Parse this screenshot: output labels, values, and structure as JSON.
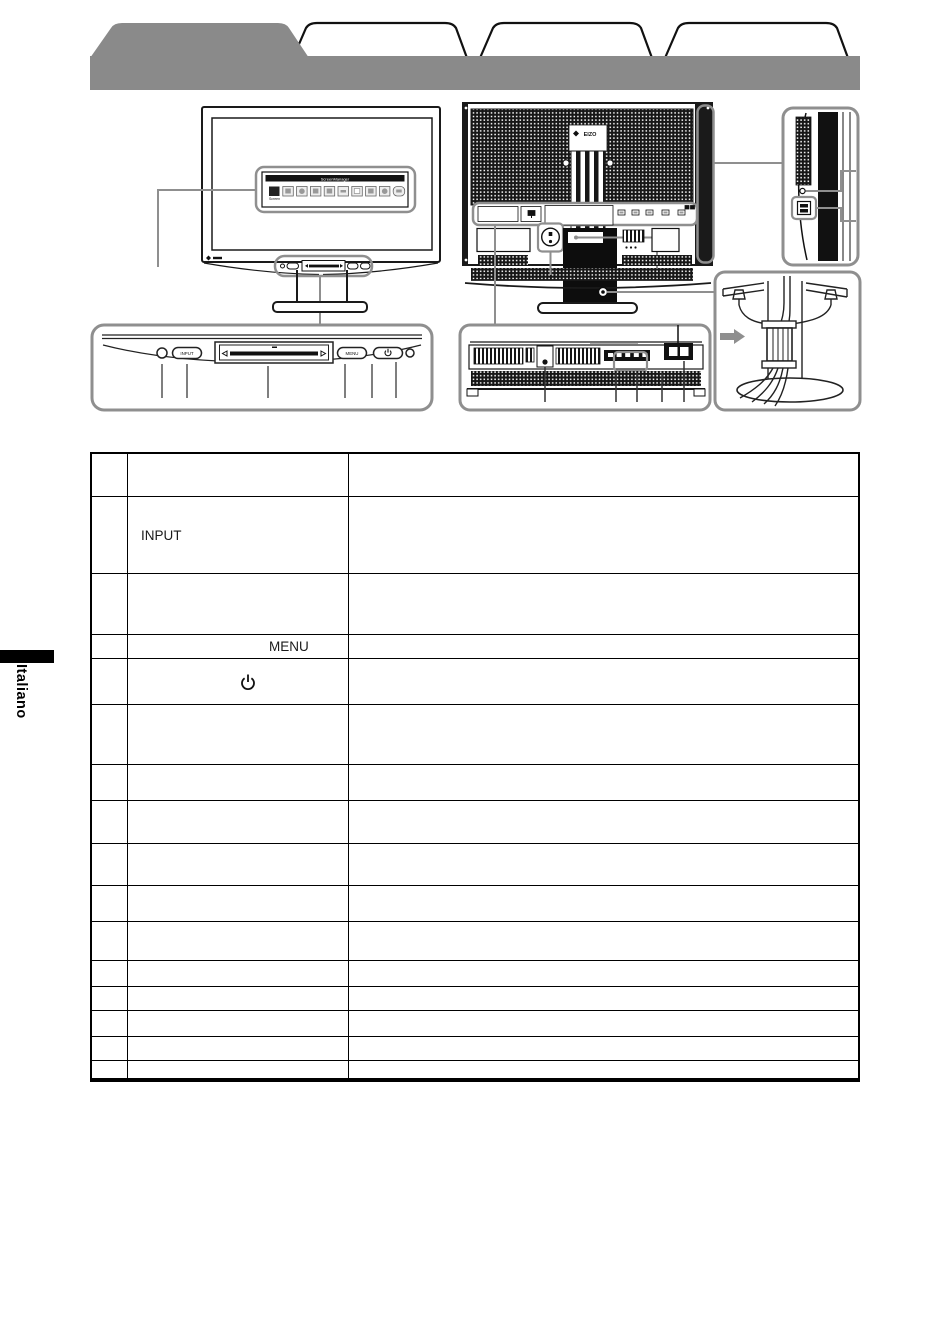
{
  "sidebar": {
    "language": "Italiano"
  },
  "tabs": {
    "active_label": "",
    "tab2_label": "",
    "tab3_label": "",
    "tab4_label": ""
  },
  "brand": {
    "logo_text": "EIZO"
  },
  "screen_menu": {
    "title": "ScreenManager",
    "selected_item": "Screen",
    "icon_count": 10
  },
  "control_panel": {
    "input_button": "INPUT",
    "menu_button": "MENU",
    "icons": [
      "sensor-icon",
      "input-button",
      "slide-bar",
      "menu-button",
      "power-button",
      "power-indicator-icon"
    ]
  },
  "colors": {
    "tab_band": "#8a8a8a",
    "callout_gray": "#8f8f8f",
    "line_black": "#1a1a1a"
  },
  "table": {
    "rows": [
      {
        "num": "",
        "label": "",
        "desc": ""
      },
      {
        "num": "",
        "label": "INPUT",
        "desc": ""
      },
      {
        "num": "",
        "label": "",
        "desc": ""
      },
      {
        "num": "",
        "label": "MENU",
        "desc": ""
      },
      {
        "num": "",
        "label": "",
        "desc": "",
        "icon": "power-icon"
      },
      {
        "num": "",
        "label": "",
        "desc": ""
      },
      {
        "num": "",
        "label": "",
        "desc": ""
      },
      {
        "num": "",
        "label": "",
        "desc": ""
      },
      {
        "num": "",
        "label": "",
        "desc": ""
      },
      {
        "num": "",
        "label": "",
        "desc": ""
      },
      {
        "num": "",
        "label": "",
        "desc": ""
      },
      {
        "num": "",
        "label": "",
        "desc": ""
      },
      {
        "num": "",
        "label": "",
        "desc": ""
      },
      {
        "num": "",
        "label": "",
        "desc": ""
      },
      {
        "num": "",
        "label": "",
        "desc": ""
      },
      {
        "num": "",
        "label": "",
        "desc": ""
      }
    ]
  }
}
